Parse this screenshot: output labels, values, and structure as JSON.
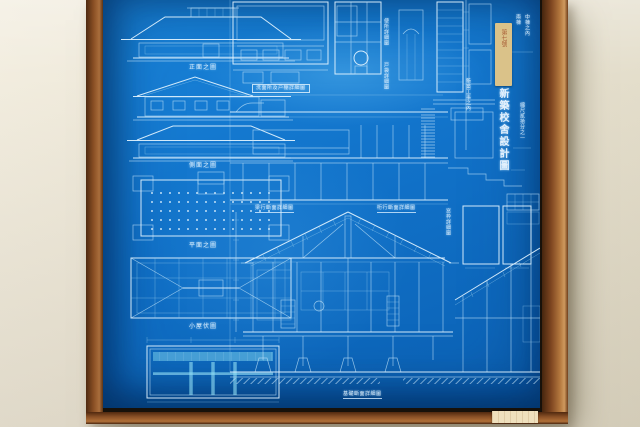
{
  "photo": {
    "wall_color": "#ece6d6",
    "frame_wood_color": "#8a4f24",
    "blueprint_blue": "#1571c4",
    "linework_color": "#e4f4fe",
    "sticker_color": "#d9c28c",
    "corner_label_color": "#efe0bd"
  },
  "title_block": {
    "title": "新築校舍設計圖",
    "sticker_text": "第七號",
    "note_left": "新築工事之內",
    "note_right_top_1": "兩棟",
    "note_right_top_2": "中棟之內",
    "note_scale": "縮尺貳拾分之一"
  },
  "left_column_labels": {
    "front_elevation": "正面之圖",
    "side_elevation": "側面之圖",
    "plan": "平面之圖",
    "roof_plan": "小屋伏圖"
  },
  "captions": {
    "detail_box": "洗面所及戸棚詳細圖",
    "section_left": "梁行斷面詳細圖",
    "section_right": "桁行斷面詳細圖",
    "right_panel_vertical": "窓枠詳細圖",
    "bottom": "基礎斷面詳細圖",
    "vertical_note_1": "便所詳細圖",
    "vertical_note_2": "戸袋詳細圖"
  }
}
